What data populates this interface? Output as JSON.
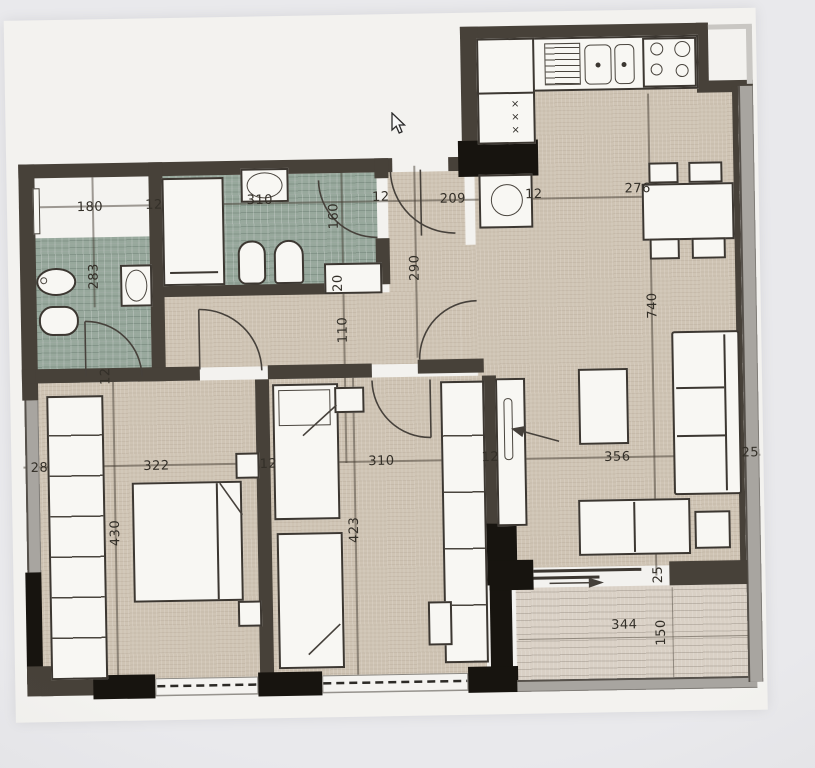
{
  "colors": {
    "wall_dark": "#474139",
    "wall_black": "#17140f",
    "wall_gray": "#a8a5a0",
    "floor_beige": "#cfc4b4",
    "bathroom_tile": "#97a89c",
    "balcony_floor": "#d9d0c5",
    "paper": "#f3f2ef",
    "background": "#e9e9ec",
    "line_ink": "#3c3731"
  },
  "labels": {
    "bathroom1_width": "180",
    "wall_top_1": "12",
    "bathroom2_width": "310",
    "wall_top_2": "12",
    "entry_width": "209",
    "wall_top_3": "12",
    "kitchen_width": "276",
    "bathroom1_depth": "283",
    "bathroom2_door": "160",
    "entry_depth": "290",
    "niche_depth": "20",
    "hallway_width": "110",
    "living_depth": "740",
    "bathroom1_wall": "12",
    "closet_column": "28",
    "bedroom1_width": "322",
    "wall_mid_1": "12",
    "bedroom2_width": "310",
    "wall_mid_2": "12",
    "living_width": "356",
    "right_wall": "25",
    "bedroom1_depth": "430",
    "bedroom2_depth": "423",
    "balcony_offset": "25",
    "balcony_width": "344",
    "balcony_depth": "150"
  },
  "kitchen": {
    "fridge_marks": "×\n×\n×"
  }
}
